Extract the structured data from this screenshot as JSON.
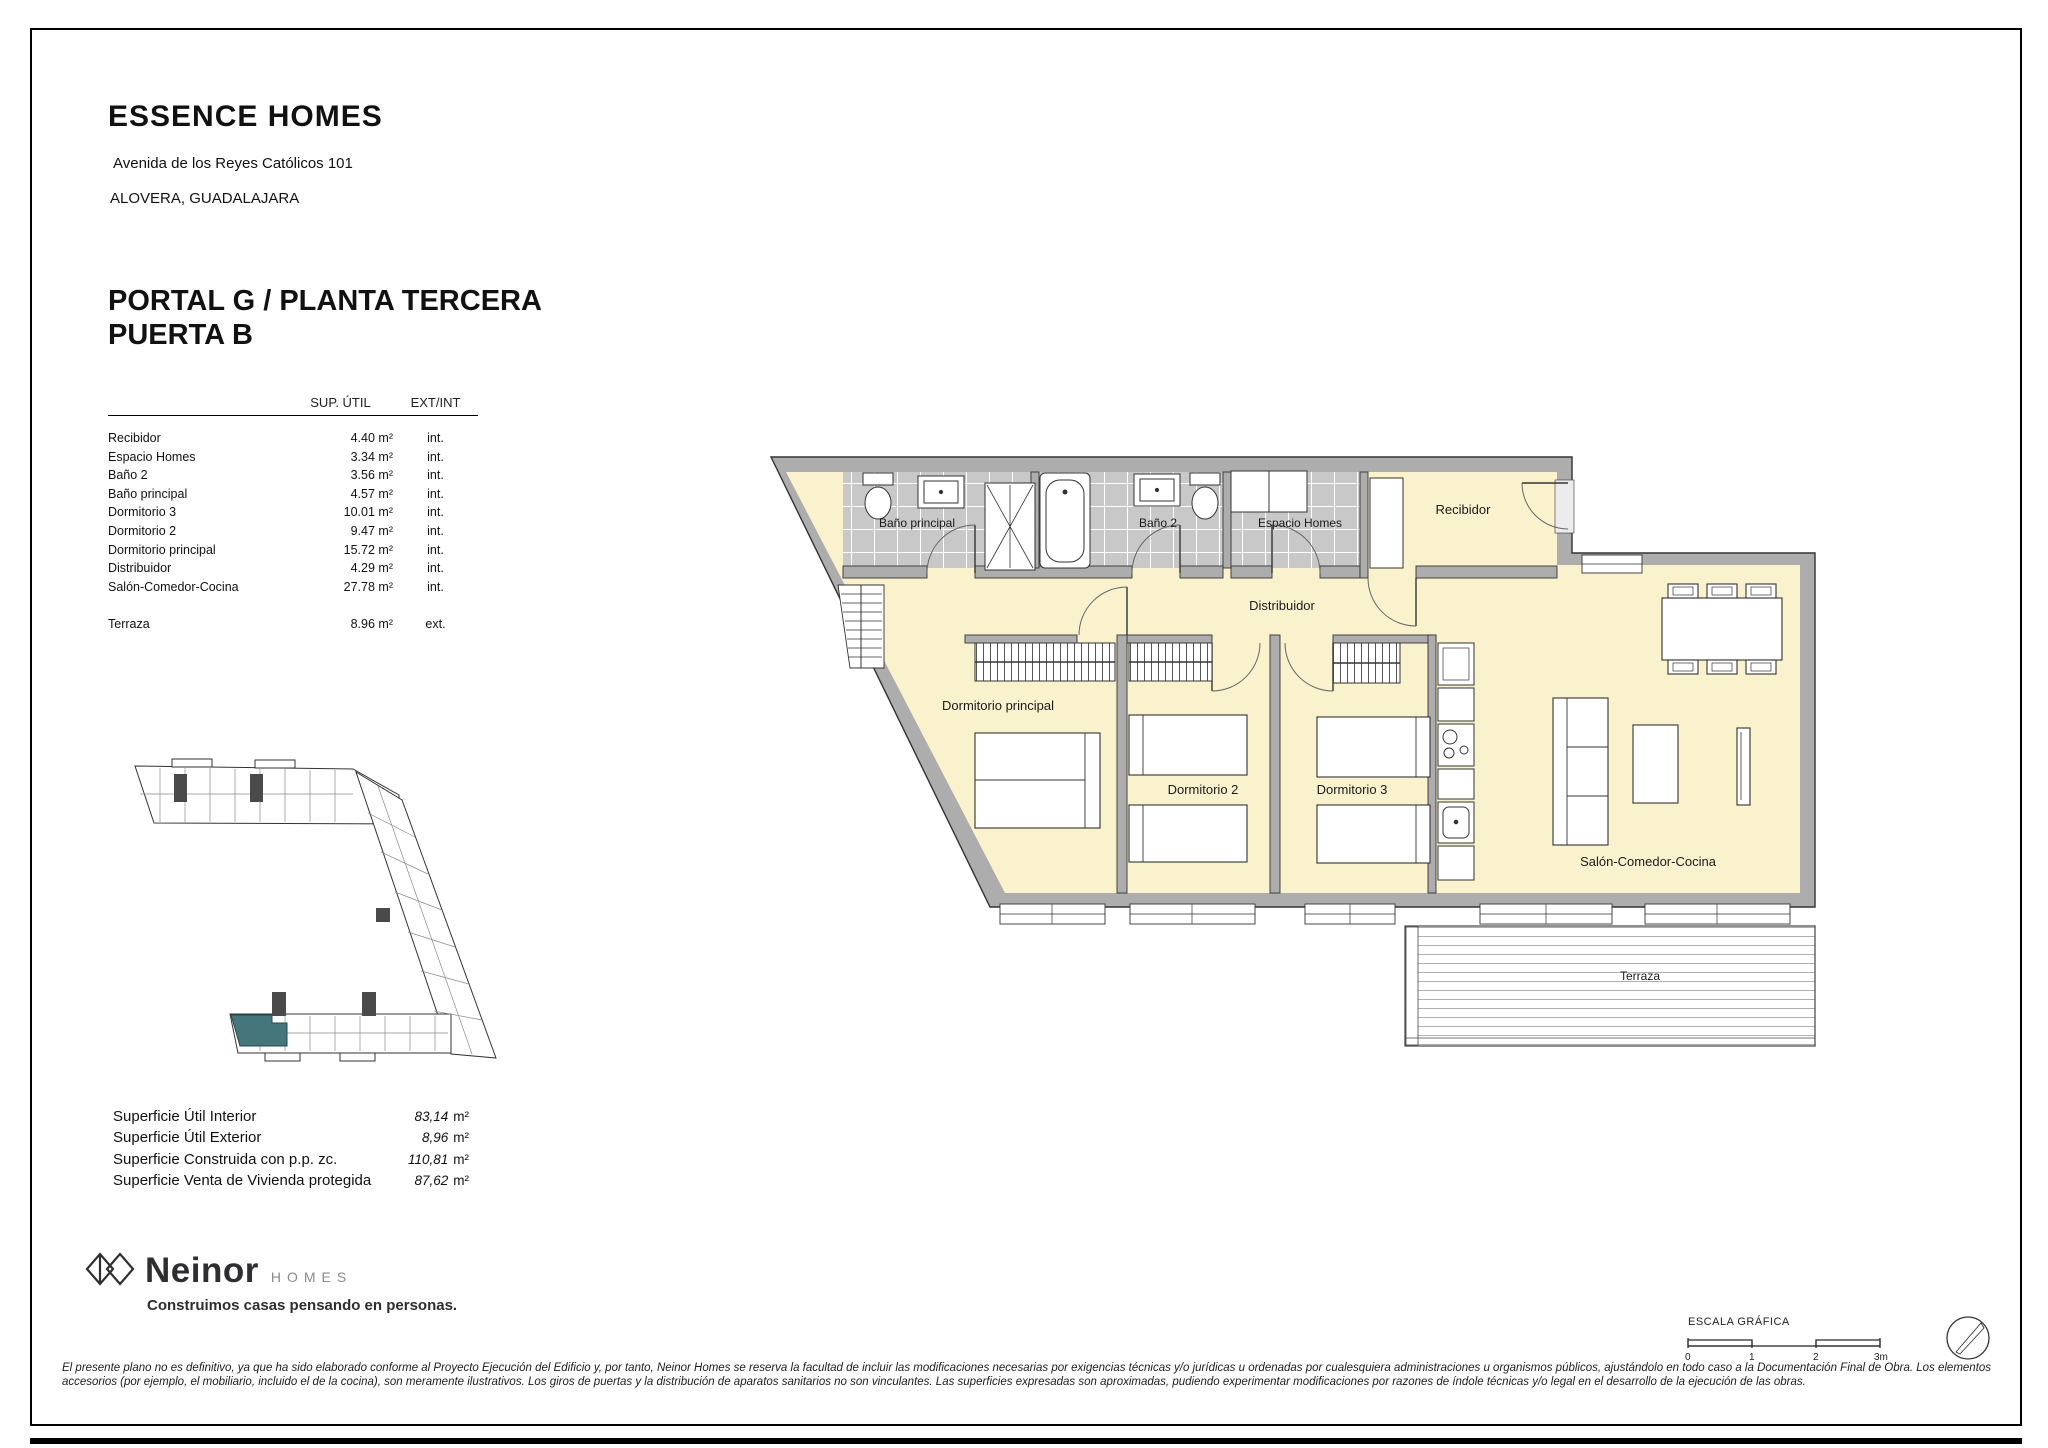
{
  "header": {
    "brand": "ESSENCE HOMES",
    "address": "Avenida de los Reyes Católicos 101",
    "city": "ALOVERA, GUADALAJARA"
  },
  "title": {
    "line1": "PORTAL G / PLANTA TERCERA",
    "line2": "PUERTA B"
  },
  "areas_table": {
    "col_sup": "SUP. ÚTIL",
    "col_ext": "EXT/INT",
    "rows": [
      {
        "name": "Recibidor",
        "value": "4.40 m²",
        "type": "int."
      },
      {
        "name": "Espacio Homes",
        "value": "3.34 m²",
        "type": "int."
      },
      {
        "name": "Baño 2",
        "value": "3.56 m²",
        "type": "int."
      },
      {
        "name": "Baño principal",
        "value": "4.57 m²",
        "type": "int."
      },
      {
        "name": "Dormitorio 3",
        "value": "10.01 m²",
        "type": "int."
      },
      {
        "name": "Dormitorio 2",
        "value": "9.47 m²",
        "type": "int."
      },
      {
        "name": "Dormitorio principal",
        "value": "15.72 m²",
        "type": "int."
      },
      {
        "name": "Distribuidor",
        "value": "4.29 m²",
        "type": "int."
      },
      {
        "name": "Salón-Comedor-Cocina",
        "value": "27.78 m²",
        "type": "int."
      },
      {
        "name": "Terraza",
        "value": "8.96 m²",
        "type": "ext."
      }
    ]
  },
  "summary": {
    "rows": [
      {
        "label": "Superficie Útil Interior",
        "value": "83,14",
        "unit": "m²"
      },
      {
        "label": "Superficie Útil Exterior",
        "value": "8,96",
        "unit": "m²"
      },
      {
        "label": "Superficie Construida con p.p. zc.",
        "value": "110,81",
        "unit": "m²"
      },
      {
        "label": "Superficie Venta de Vivienda protegida",
        "value": "87,62",
        "unit": "m²"
      }
    ]
  },
  "plan": {
    "labels": {
      "bano_principal": "Baño principal",
      "bano2": "Baño 2",
      "espacio": "Espacio Homes",
      "recibidor": "Recibidor",
      "distribuidor": "Distribuidor",
      "dorm_principal": "Dormitorio principal",
      "dorm2": "Dormitorio 2",
      "dorm3": "Dormitorio 3",
      "salon": "Salón-Comedor-Cocina",
      "terraza": "Terraza"
    },
    "colors": {
      "floor": "#FAF1CD",
      "wall": "#ADADAD",
      "tile": "#C8C8C8",
      "highlight": "#44767C"
    }
  },
  "footer": {
    "logo_text": "Neinor",
    "logo_sub": "HOMES",
    "tagline": "Construimos casas pensando en personas.",
    "legal": "El presente plano no es definitivo, ya que ha sido elaborado conforme al Proyecto Ejecución del Edificio y, por tanto, Neinor Homes se reserva la facultad de incluir las modificaciones necesarias por exigencias técnicas y/o jurídicas u ordenadas por cualesquiera administraciones u organismos públicos, ajustándolo en todo caso a la Documentación Final de Obra. Los elementos accesorios (por ejemplo, el mobiliario, incluido el de la cocina), son meramente ilustrativos. Los giros de puertas y la distribución de aparatos sanitarios no son vinculantes. Las superficies expresadas son aproximadas, pudiendo experimentar modificaciones por razones de índole técnicas y/o legal en el desarrollo de la ejecución de las obras."
  },
  "scale": {
    "label": "ESCALA GRÁFICA",
    "ticks": [
      "0",
      "1",
      "2",
      "3m"
    ]
  }
}
